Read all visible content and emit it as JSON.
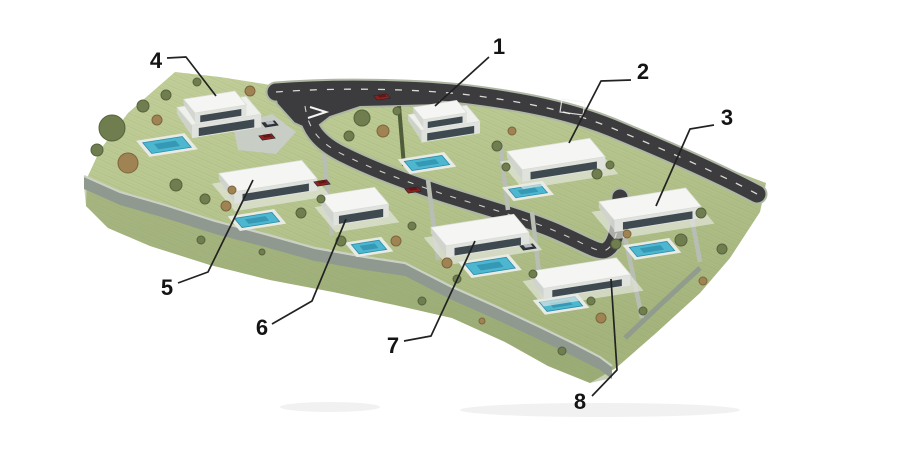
{
  "scene": {
    "canvas": {
      "w": 900,
      "h": 455
    },
    "colors": {
      "bg": "#ffffff",
      "road": "#3c3c3e",
      "road_edge": "#aeb7a4",
      "marking": "#f4f4f0",
      "wall_face": "#8f998f",
      "wall_top": "#ccd1c6",
      "lot_wall": "#b8beb4",
      "hedge": "#4f5d3b",
      "slope": "#93a470",
      "paving": "#c8cdc6",
      "roof": "#f5f6f3",
      "roof_lower": "#eef0ec",
      "facade": "#dfe2dd",
      "side": "#cfd3ce",
      "glass": "#3f4a50",
      "deck": "#e8eae4",
      "pool": "#4db7d0",
      "pool_deep": "#2b8cab",
      "tree_olive": "#6f7d4f",
      "tree_olive_dk": "#56633c",
      "tree_brown": "#a08352",
      "tree_brown_dk": "#7d653e",
      "tree_dark": "#55663f",
      "tree_dark_dk": "#41502f",
      "car_red": "#8e2222",
      "car_dark": "#30363d",
      "smudge": "#d9d9d9",
      "label": "#141414",
      "leader": "#222222"
    },
    "terrain": [
      [
        175,
        72
      ],
      [
        220,
        77
      ],
      [
        277,
        86
      ],
      [
        340,
        87
      ],
      [
        455,
        89
      ],
      [
        540,
        98
      ],
      [
        585,
        108
      ],
      [
        640,
        130
      ],
      [
        700,
        158
      ],
      [
        766,
        183
      ],
      [
        760,
        212
      ],
      [
        730,
        258
      ],
      [
        700,
        293
      ],
      [
        655,
        334
      ],
      [
        616,
        368
      ],
      [
        590,
        383
      ],
      [
        548,
        366
      ],
      [
        505,
        342
      ],
      [
        452,
        318
      ],
      [
        395,
        305
      ],
      [
        333,
        292
      ],
      [
        270,
        280
      ],
      [
        210,
        265
      ],
      [
        150,
        246
      ],
      [
        108,
        228
      ],
      [
        86,
        206
      ],
      [
        87,
        178
      ],
      [
        100,
        150
      ],
      [
        128,
        113
      ]
    ],
    "slope": [
      [
        84,
        186
      ],
      [
        130,
        204
      ],
      [
        180,
        218
      ],
      [
        235,
        233
      ],
      [
        290,
        249
      ],
      [
        345,
        262
      ],
      [
        400,
        274
      ],
      [
        455,
        299
      ],
      [
        510,
        321
      ],
      [
        555,
        343
      ],
      [
        590,
        362
      ],
      [
        612,
        378
      ],
      [
        590,
        383
      ],
      [
        548,
        366
      ],
      [
        505,
        342
      ],
      [
        452,
        318
      ],
      [
        395,
        305
      ],
      [
        333,
        292
      ],
      [
        270,
        280
      ],
      [
        210,
        265
      ],
      [
        150,
        246
      ],
      [
        108,
        228
      ],
      [
        86,
        206
      ]
    ],
    "wall_top": [
      [
        84,
        176
      ],
      [
        120,
        192
      ],
      [
        165,
        205
      ],
      [
        215,
        221
      ],
      [
        265,
        234
      ],
      [
        315,
        248
      ],
      [
        365,
        257
      ],
      [
        405,
        263
      ],
      [
        450,
        286
      ],
      [
        495,
        306
      ],
      [
        540,
        327
      ],
      [
        575,
        344
      ],
      [
        600,
        357
      ],
      [
        612,
        366
      ]
    ],
    "wall_height": 13,
    "side_wall": [
      [
        700,
        268
      ],
      [
        660,
        305
      ],
      [
        625,
        338
      ]
    ],
    "lot_walls": [
      [
        [
          324,
          155
        ],
        [
          332,
          236
        ]
      ],
      [
        [
          428,
          180
        ],
        [
          438,
          260
        ]
      ],
      [
        [
          500,
          142
        ],
        [
          508,
          210
        ]
      ],
      [
        [
          532,
          212
        ],
        [
          542,
          298
        ]
      ],
      [
        [
          624,
          232
        ],
        [
          642,
          318
        ]
      ],
      [
        [
          690,
          208
        ],
        [
          700,
          262
        ]
      ]
    ],
    "hedge": [
      [
        399,
        106
      ],
      [
        404,
        166
      ]
    ],
    "roads": {
      "main": "M276,92 C340,87 420,89 470,95 C525,102 570,111 612,128 C655,146 712,170 757,194",
      "branch": "M305,106 C308,128 318,142 342,154 C372,169 402,180 440,193 C480,206 532,220 562,234 C585,244 600,254 606,250 C614,246 618,232 619,215 L620,197",
      "junction": [
        [
          272,
          87
        ],
        [
          440,
          89
        ],
        [
          440,
          105
        ],
        [
          360,
          107
        ],
        [
          330,
          117
        ],
        [
          312,
          131
        ],
        [
          294,
          123
        ],
        [
          277,
          104
        ]
      ],
      "main_width": 17,
      "branch_width": 15
    },
    "driveway": [
      [
        233,
        126
      ],
      [
        272,
        114
      ],
      [
        296,
        132
      ],
      [
        276,
        154
      ],
      [
        238,
        150
      ]
    ],
    "markings": {
      "arrow": [
        [
          310,
          107
        ],
        [
          326,
          112
        ],
        [
          308,
          118
        ]
      ],
      "stall": [
        [
          562,
          99
        ],
        [
          585,
          102
        ],
        [
          583,
          115
        ],
        [
          560,
          112
        ]
      ]
    },
    "houses": [
      {
        "n": 1,
        "cx": 440,
        "cy": 110,
        "a": 22,
        "b": 8,
        "h": 10,
        "stories": 2
      },
      {
        "n": 2,
        "cx": 556,
        "cy": 154,
        "a": 42,
        "b": 12,
        "h": 12,
        "stories": 1
      },
      {
        "n": 3,
        "cx": 650,
        "cy": 204,
        "a": 44,
        "b": 12,
        "h": 12,
        "stories": 1
      },
      {
        "n": 4,
        "cx": 215,
        "cy": 102,
        "a": 26,
        "b": 9,
        "h": 11,
        "stories": 2
      },
      {
        "n": 5,
        "cx": 268,
        "cy": 176,
        "a": 42,
        "b": 12,
        "h": 12,
        "stories": 1
      },
      {
        "n": 6,
        "cx": 354,
        "cy": 200,
        "a": 28,
        "b": 11,
        "h": 13,
        "stories": 1
      },
      {
        "n": 7,
        "cx": 480,
        "cy": 230,
        "a": 42,
        "b": 12,
        "h": 12,
        "stories": 1
      },
      {
        "n": 8,
        "cx": 580,
        "cy": 273,
        "a": 44,
        "b": 11,
        "h": 11,
        "stories": 1
      }
    ],
    "pools": [
      {
        "n": 1,
        "cx": 427,
        "cy": 163,
        "a": 19,
        "b": 6
      },
      {
        "n": 2,
        "cx": 528,
        "cy": 191,
        "a": 16,
        "b": 5.5
      },
      {
        "n": 3,
        "cx": 652,
        "cy": 249,
        "a": 19,
        "b": 6
      },
      {
        "n": 4,
        "cx": 167,
        "cy": 145,
        "a": 20,
        "b": 7
      },
      {
        "n": 5,
        "cx": 257,
        "cy": 220,
        "a": 19,
        "b": 6
      },
      {
        "n": 6,
        "cx": 369,
        "cy": 247,
        "a": 14,
        "b": 6
      },
      {
        "n": 7,
        "cx": 490,
        "cy": 266,
        "a": 21,
        "b": 7
      },
      {
        "n": 8,
        "cx": 561,
        "cy": 304,
        "a": 18,
        "b": 6
      }
    ],
    "cars": [
      {
        "x": 382,
        "y": 97,
        "color": "red"
      },
      {
        "x": 267,
        "y": 137,
        "color": "red"
      },
      {
        "x": 270,
        "y": 124,
        "color": "dark"
      },
      {
        "x": 322,
        "y": 183,
        "color": "red"
      },
      {
        "x": 413,
        "y": 190,
        "color": "red"
      },
      {
        "x": 528,
        "y": 247,
        "color": "dark"
      }
    ],
    "trees": [
      [
        112,
        128,
        13,
        "olive"
      ],
      [
        128,
        163,
        10,
        "brown"
      ],
      [
        97,
        150,
        6,
        "olive"
      ],
      [
        143,
        106,
        6,
        "olive"
      ],
      [
        166,
        95,
        5,
        "olive"
      ],
      [
        197,
        82,
        4,
        "olive"
      ],
      [
        250,
        91,
        5,
        "brown"
      ],
      [
        157,
        120,
        5,
        "brown"
      ],
      [
        176,
        185,
        6,
        "olive"
      ],
      [
        205,
        199,
        5,
        "olive"
      ],
      [
        232,
        190,
        4,
        "brown"
      ],
      [
        362,
        118,
        8,
        "olive"
      ],
      [
        383,
        131,
        6,
        "brown"
      ],
      [
        349,
        136,
        5,
        "olive"
      ],
      [
        397,
        111,
        4,
        "olive"
      ],
      [
        497,
        146,
        5,
        "olive"
      ],
      [
        506,
        167,
        4,
        "olive"
      ],
      [
        512,
        131,
        4,
        "brown"
      ],
      [
        597,
        174,
        5,
        "olive"
      ],
      [
        610,
        165,
        4,
        "olive"
      ],
      [
        616,
        244,
        5,
        "olive"
      ],
      [
        681,
        240,
        6,
        "olive"
      ],
      [
        701,
        213,
        5,
        "olive"
      ],
      [
        627,
        234,
        4,
        "brown"
      ],
      [
        722,
        249,
        5,
        "olive"
      ],
      [
        703,
        281,
        4,
        "brown"
      ],
      [
        226,
        206,
        5,
        "brown"
      ],
      [
        301,
        213,
        5,
        "olive"
      ],
      [
        321,
        199,
        4,
        "olive"
      ],
      [
        341,
        241,
        5,
        "olive"
      ],
      [
        396,
        241,
        5,
        "brown"
      ],
      [
        412,
        226,
        4,
        "olive"
      ],
      [
        447,
        263,
        5,
        "brown"
      ],
      [
        457,
        279,
        4,
        "olive"
      ],
      [
        533,
        274,
        4,
        "olive"
      ],
      [
        601,
        318,
        5,
        "brown"
      ],
      [
        591,
        301,
        4,
        "olive"
      ],
      [
        643,
        311,
        4,
        "olive"
      ],
      [
        201,
        240,
        4,
        "olive"
      ],
      [
        262,
        252,
        3,
        "olive"
      ],
      [
        422,
        301,
        4,
        "olive"
      ],
      [
        482,
        321,
        3,
        "brown"
      ],
      [
        562,
        351,
        4,
        "olive"
      ]
    ],
    "smudges": [
      [
        600,
        410,
        140,
        7
      ],
      [
        330,
        407,
        50,
        5
      ]
    ],
    "labels": [
      {
        "text": "1",
        "x": 499,
        "y": 46,
        "line": [
          [
            489,
            57
          ],
          [
            435,
            106
          ]
        ]
      },
      {
        "text": "2",
        "x": 643,
        "y": 71,
        "line": [
          [
            631,
            80
          ],
          [
            601,
            81
          ],
          [
            569,
            143
          ]
        ]
      },
      {
        "text": "3",
        "x": 727,
        "y": 117,
        "line": [
          [
            714,
            125
          ],
          [
            690,
            129
          ],
          [
            656,
            206
          ]
        ]
      },
      {
        "text": "4",
        "x": 156,
        "y": 60,
        "line": [
          [
            167,
            58
          ],
          [
            186,
            57
          ],
          [
            216,
            96
          ]
        ]
      },
      {
        "text": "5",
        "x": 167,
        "y": 287,
        "line": [
          [
            178,
            283
          ],
          [
            208,
            272
          ],
          [
            253,
            180
          ]
        ]
      },
      {
        "text": "6",
        "x": 262,
        "y": 327,
        "line": [
          [
            272,
            324
          ],
          [
            312,
            301
          ],
          [
            346,
            219
          ]
        ]
      },
      {
        "text": "7",
        "x": 393,
        "y": 345,
        "line": [
          [
            404,
            341
          ],
          [
            431,
            336
          ],
          [
            475,
            241
          ]
        ]
      },
      {
        "text": "8",
        "x": 580,
        "y": 401,
        "line": [
          [
            592,
            396
          ],
          [
            617,
            370
          ],
          [
            611,
            279
          ]
        ]
      }
    ]
  }
}
